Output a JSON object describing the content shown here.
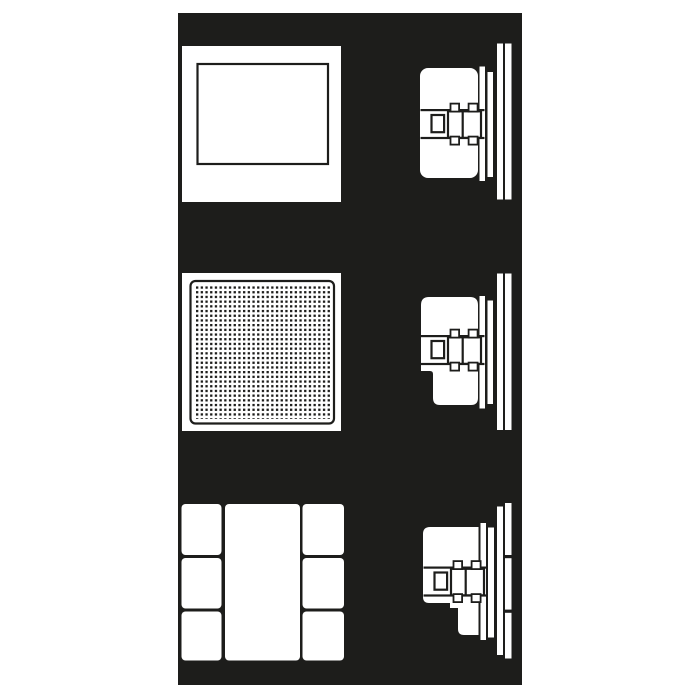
{
  "image": {
    "kind": "technical-line-drawing",
    "rows": 3
  },
  "colors": {
    "ink": "#1d1d1b",
    "paper": "#ffffff",
    "page_background": "#ffffff"
  },
  "figures": [
    {
      "id": "row-1",
      "front_view": "surface-frame",
      "side_view": "flush-mount-unit"
    },
    {
      "id": "row-2",
      "front_view": "perforated-grille",
      "side_view": "flush-mount-unit-notched"
    },
    {
      "id": "row-3",
      "front_view": "modular-faceplate",
      "side_view": "flush-mount-unit-stepped"
    }
  ],
  "grille": {
    "pattern": "square-dot-grid",
    "dot_size_px": 2.3,
    "pitch_px": 4.7
  }
}
